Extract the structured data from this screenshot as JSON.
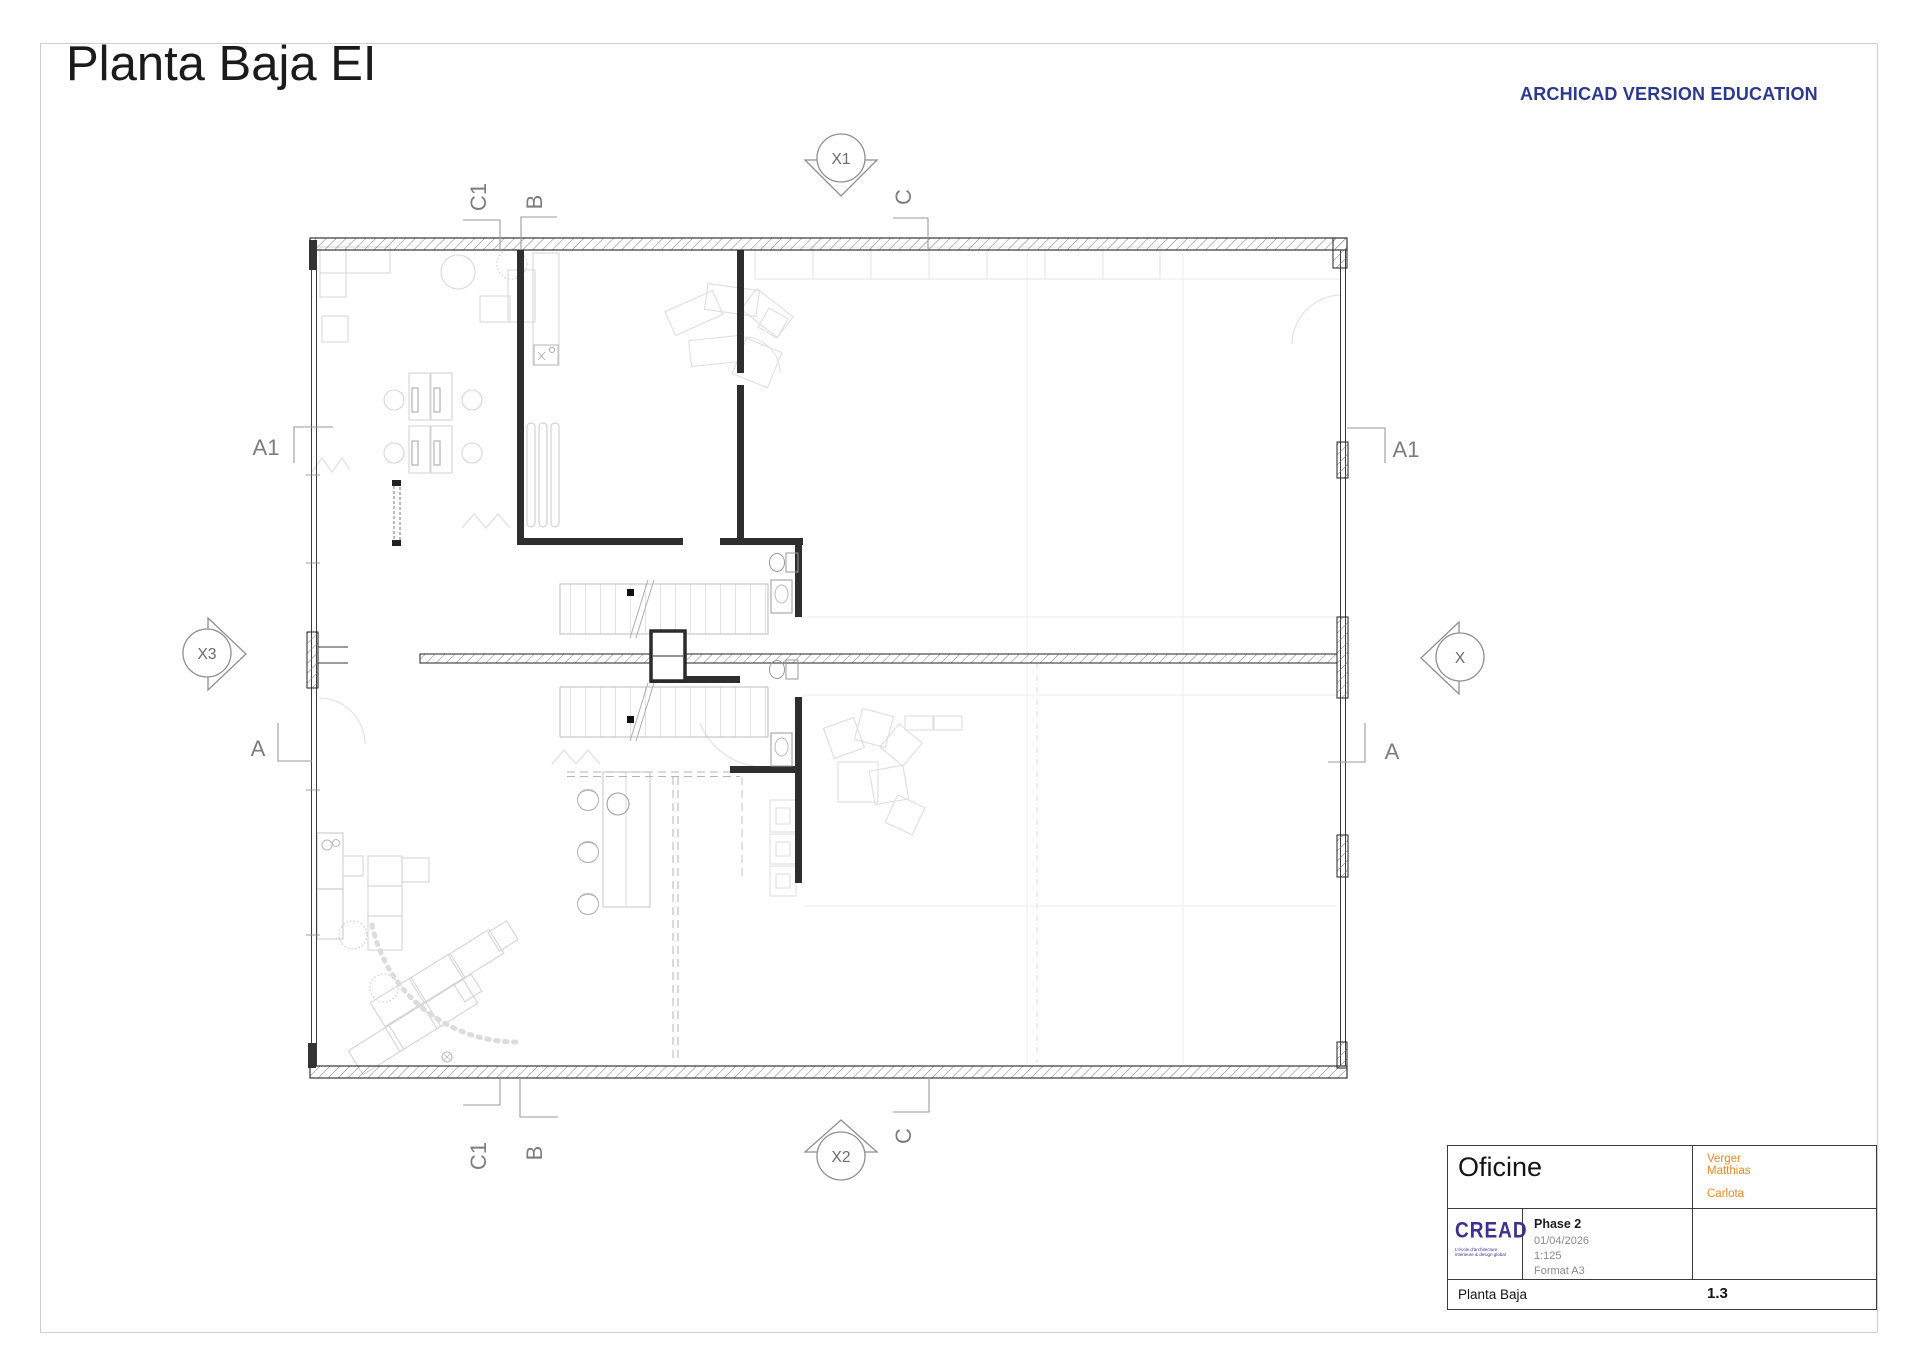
{
  "page": {
    "title": "Planta Baja EI",
    "watermark": "ARCHICAD VERSION EDUCATION"
  },
  "plan": {
    "markers": {
      "x1": "X1",
      "x2": "X2",
      "x3": "X3",
      "x_right": "X"
    },
    "labels": {
      "a1": "A1",
      "a": "A",
      "b": "B",
      "c": "C",
      "c1": "C1"
    }
  },
  "title_block": {
    "project": "Oficine",
    "author_line1": "Verger",
    "author_line2": "Matthias",
    "author_line3": "Carlota",
    "logo_text": "CREAD",
    "logo_tagline1": "L'école d'architecture",
    "logo_tagline2": "intérieure & design global",
    "phase": "Phase 2",
    "date": "01/04/2026",
    "scale": "1:125",
    "format": "Format A3",
    "drawing_title": "Planta Baja",
    "drawing_number": "1.3"
  },
  "colors": {
    "watermark_blue": "#2b3990",
    "author_orange": "#f1891d",
    "logo_purple": "#3b3191",
    "wall_dark": "#2e2e2e"
  }
}
